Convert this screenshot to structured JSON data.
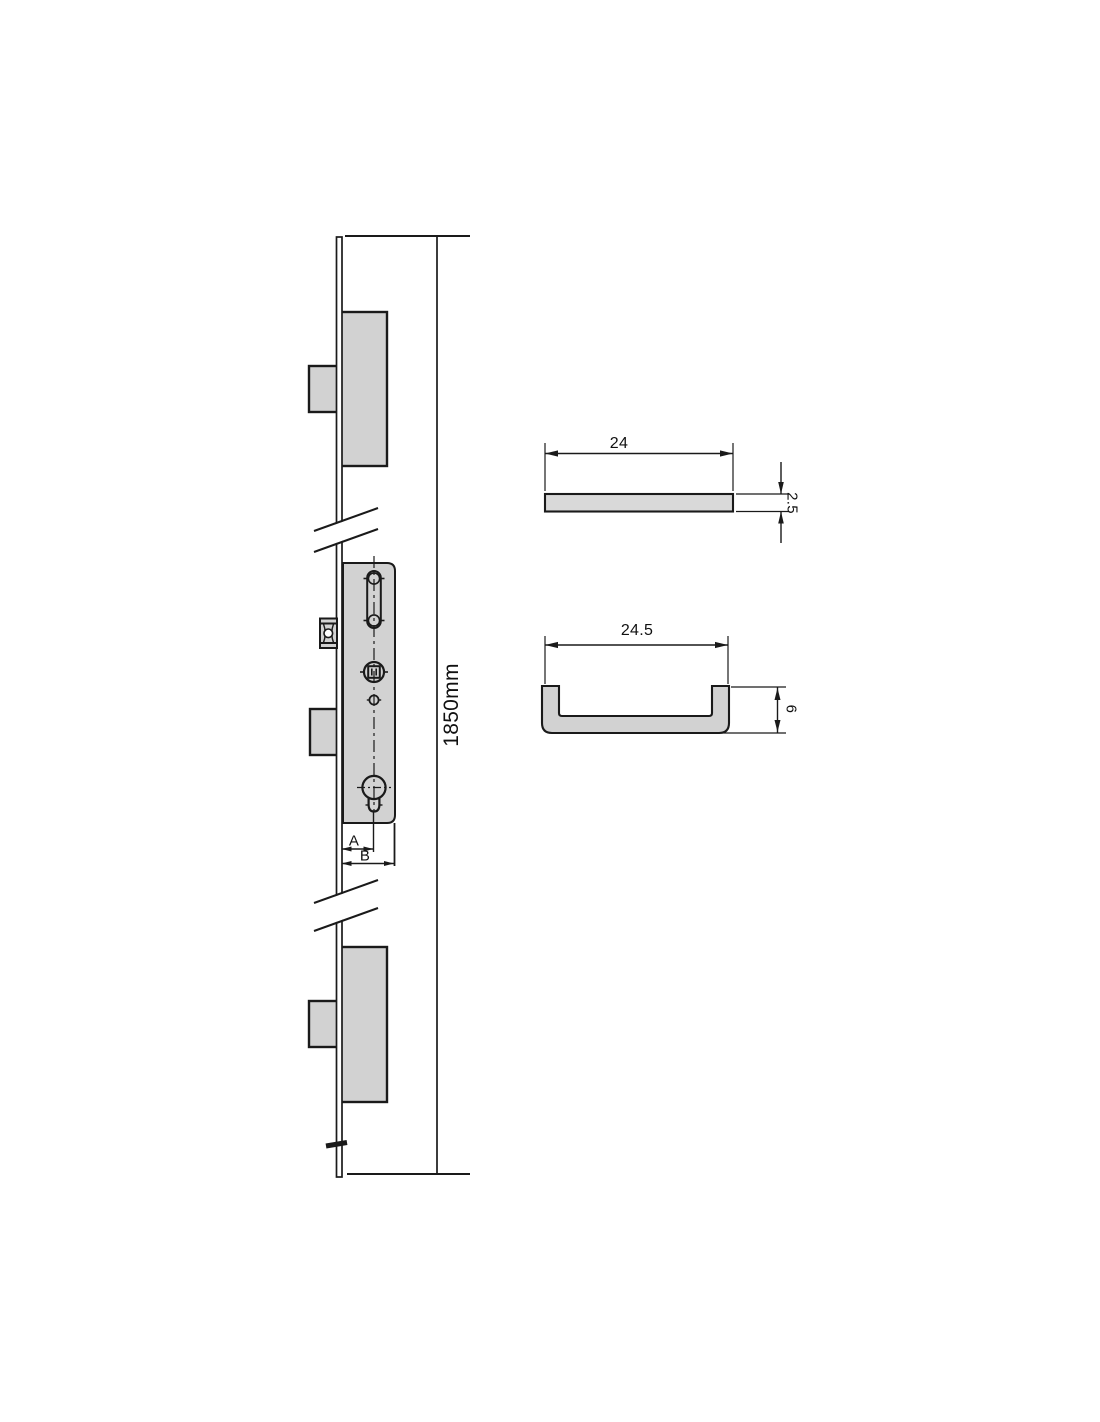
{
  "drawing": {
    "kind": "technical-drawing-multipoint-door-lock",
    "colors": {
      "background": "#ffffff",
      "part_fill": "#d2d2d2",
      "line": "#1a1a1a"
    },
    "elevation": {
      "overall_length_label": "1850mm",
      "dim_a_label": "A",
      "dim_b_label": "B"
    },
    "faceplate_section": {
      "width_label": "24",
      "thickness_label": "2.5"
    },
    "channel_section": {
      "width_label": "24.5",
      "depth_label": "6"
    },
    "dimensions_mm": {
      "overall_length": 1850,
      "faceplate_width": 24,
      "faceplate_thickness": 2.5,
      "channel_width": 24.5,
      "channel_depth": 6
    }
  }
}
